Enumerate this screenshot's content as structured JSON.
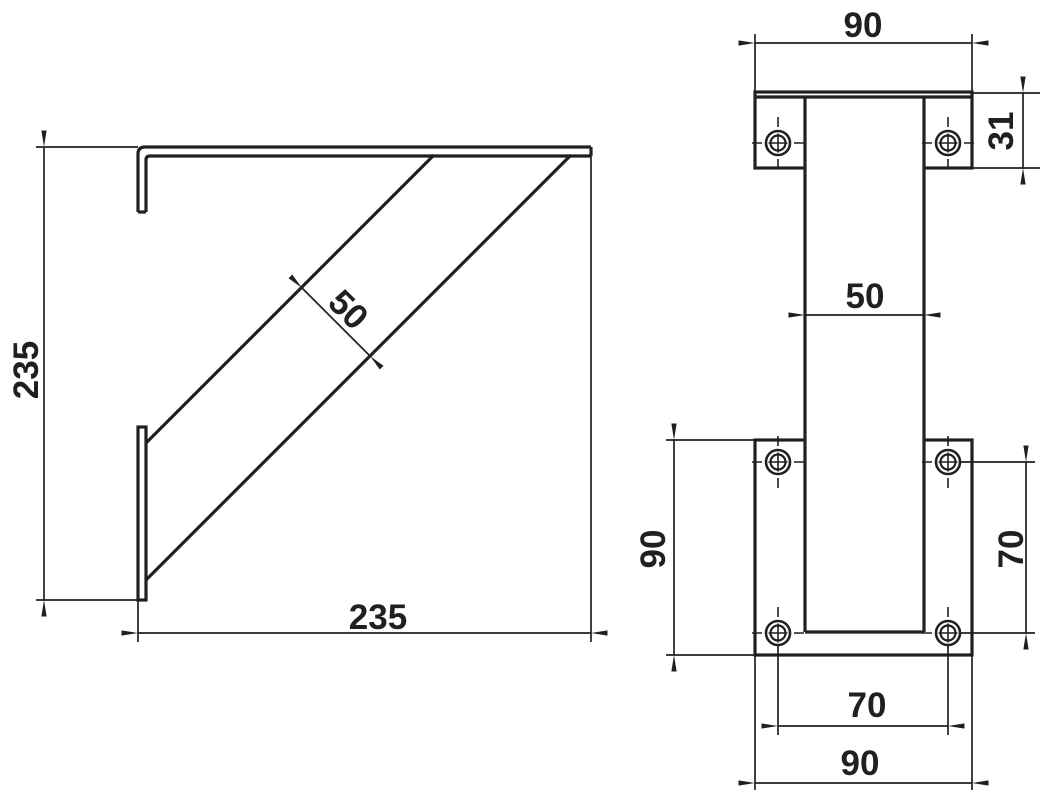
{
  "drawing": {
    "type": "technical-dimension-drawing",
    "subject": "wall shelf bracket, two orthographic views",
    "units_shown": "mm (implied, unlabeled)",
    "colors": {
      "background": "#ffffff",
      "line": "#231f20",
      "text": "#231f20"
    },
    "side_view": {
      "name": "side view (bracket arm with diagonal brace)",
      "labels": {
        "height": "235",
        "depth": "235",
        "brace_width": "50"
      }
    },
    "front_view": {
      "name": "front view (wall plates and channel)",
      "labels": {
        "top_plate_width": "90",
        "top_plate_height": "31",
        "channel_width": "50",
        "bottom_plate_height": "90",
        "hole_spacing_vertical": "70",
        "hole_spacing_horizontal": "70",
        "bottom_plate_width": "90"
      },
      "hole_count": 6
    }
  }
}
